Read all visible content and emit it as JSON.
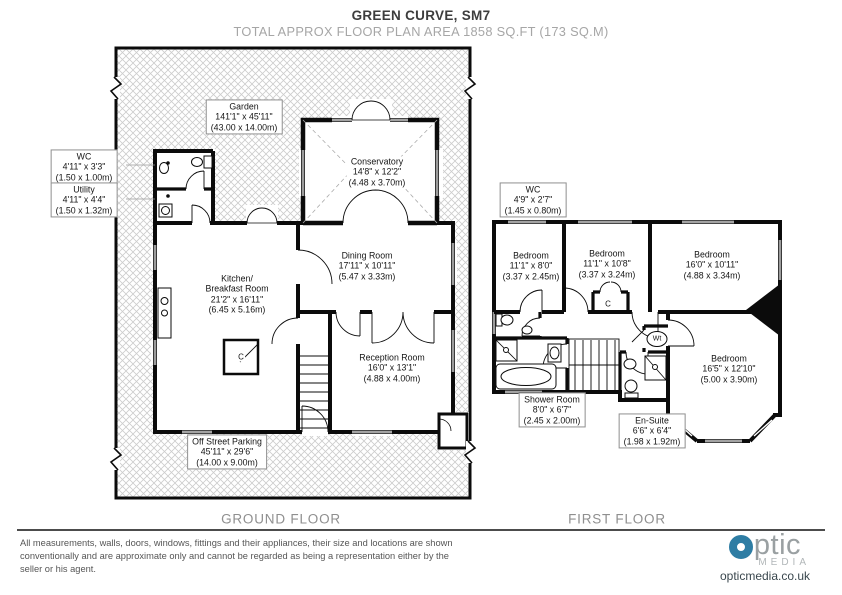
{
  "header": {
    "title": "GREEN CURVE, SM7",
    "subtitle": "TOTAL APPROX FLOOR PLAN AREA 1858 SQ.FT (173 SQ.M)"
  },
  "ground_floor": {
    "title": "GROUND FLOOR",
    "garden": {
      "name": "Garden",
      "imperial": "141'1\" x 45'11\"",
      "metric": "(43.00 x 14.00m)"
    },
    "wc": {
      "name": "WC",
      "imperial": "4'11\" x 3'3\"",
      "metric": "(1.50 x 1.00m)"
    },
    "utility": {
      "name": "Utility",
      "imperial": "4'11\" x 4'4\"",
      "metric": "(1.50 x 1.32m)"
    },
    "conservatory": {
      "name": "Conservatory",
      "imperial": "14'8\" x 12'2\"",
      "metric": "(4.48 x 3.70m)"
    },
    "dining_room": {
      "name": "Dining Room",
      "imperial": "17'11\" x 10'11\"",
      "metric": "(5.47 x 3.33m)"
    },
    "kitchen": {
      "name": "Kitchen/",
      "name2": "Breakfast Room",
      "imperial": "21'2\" x 16'11\"",
      "metric": "(6.45 x 5.16m)"
    },
    "reception_room": {
      "name": "Reception Room",
      "imperial": "16'0\" x 13'1\"",
      "metric": "(4.88 x 4.00m)"
    },
    "parking": {
      "name": "Off Street Parking",
      "imperial": "45'11\" x 29'6\"",
      "metric": "(14.00 x 9.00m)"
    },
    "cupboard": "C"
  },
  "first_floor": {
    "title": "FIRST FLOOR",
    "wc": {
      "name": "WC",
      "imperial": "4'9\" x 2'7\"",
      "metric": "(1.45 x 0.80m)"
    },
    "bedroom1": {
      "name": "Bedroom",
      "imperial": "11'1\" x 8'0\"",
      "metric": "(3.37 x 2.45m)"
    },
    "bedroom2": {
      "name": "Bedroom",
      "imperial": "11'1\" x 10'8\"",
      "metric": "(3.37 x 3.24m)"
    },
    "bedroom3": {
      "name": "Bedroom",
      "imperial": "16'0\" x 10'11\"",
      "metric": "(4.88 x 3.34m)"
    },
    "bedroom4": {
      "name": "Bedroom",
      "imperial": "16'5\" x 12'10\"",
      "metric": "(5.00 x 3.90m)"
    },
    "shower_room": {
      "name": "Shower Room",
      "imperial": "8'0\" x 6'7\"",
      "metric": "(2.45 x 2.00m)"
    },
    "ensuite": {
      "name": "En-Suite",
      "imperial": "6'6\" x 6'4\"",
      "metric": "(1.98 x 1.92m)"
    },
    "cupboard": "C",
    "water_tank": "Wt"
  },
  "footer": {
    "disclaimer": "All measurements, walls, doors, windows, fittings and their appliances, their size and locations are shown conventionally and are approximate only and cannot be regarded as being a representation either by the seller or his agent.",
    "logo": {
      "rest": "ptic",
      "media": "MEDIA",
      "url": "opticmedia.co.uk"
    }
  },
  "colors": {
    "wall": "#0b0b0b",
    "hatch": "#cccccc",
    "logo_accent": "#2e7da4",
    "muted_text": "#8f8f8f"
  }
}
